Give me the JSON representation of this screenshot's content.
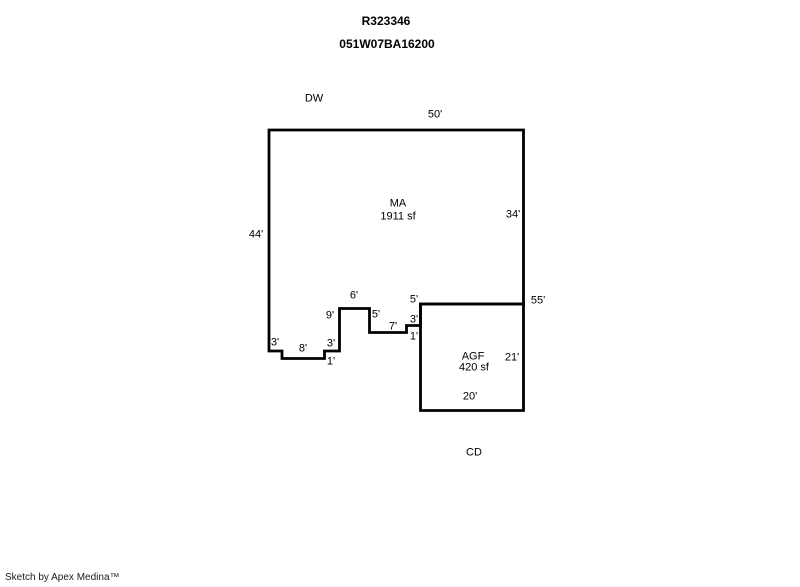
{
  "header": {
    "record_number": "R323346",
    "parcel_number": "051W07BA16200"
  },
  "sketch": {
    "labels": {
      "dw": "DW",
      "ma": "MA",
      "ma_area": "1911 sf",
      "agf": "AGF",
      "agf_area": "420 sf",
      "cd": "CD"
    },
    "dimensions": {
      "ma_top": "50'",
      "ma_left": "44'",
      "ma_right": "34'",
      "right_total": "55'",
      "bump_top": "6'",
      "bump_left": "9'",
      "bump_right": "5'",
      "jog_mid": "7'",
      "jog_step_up": "1'",
      "jog_right": "3'",
      "jog_wall": "5'",
      "notch_left": "3'",
      "notch_bottom": "8'",
      "notch_right": "3'",
      "notch_step": "1'",
      "agf_right": "21'",
      "agf_bottom": "20'"
    },
    "line_color": "#000000"
  },
  "footer": {
    "credit": "Sketch by Apex Medina™"
  }
}
